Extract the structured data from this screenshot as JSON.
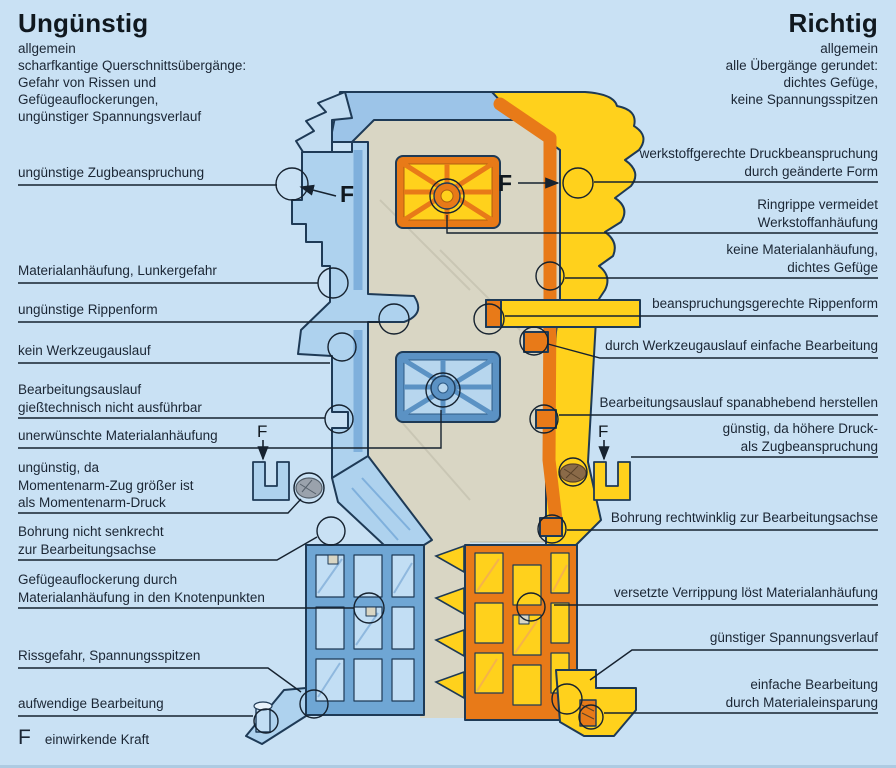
{
  "page": {
    "title_left": "Ungünstig",
    "title_right": "Richtig"
  },
  "left": {
    "heading": "Ungünstig",
    "intro": "allgemein\nscharfkantige Querschnittsübergänge:\nGefahr von Rissen und\nGefügeauflockerungen,\nungünstiger Spannungsverlauf",
    "labels": [
      {
        "text": "ungünstige Zugbeanspruchung"
      },
      {
        "text": "Materialanhäufung, Lunkergefahr"
      },
      {
        "text": "ungünstige Rippenform"
      },
      {
        "text": "kein Werkzeugauslauf"
      },
      {
        "text": "Bearbeitungsauslauf\ngießtechnisch nicht ausführbar"
      },
      {
        "text": "unerwünschte Materialanhäufung"
      },
      {
        "text": "ungünstig, da\nMomentenarm-Zug größer ist\nals Momentenarm-Druck"
      },
      {
        "text": "Bohrung nicht senkrecht\nzur Bearbeitungsachse"
      },
      {
        "text": "Gefügeauflockerung durch\nMaterialanhäufung in den Knotenpunkten"
      },
      {
        "text": "Rissgefahr, Spannungsspitzen"
      },
      {
        "text": "aufwendige Bearbeitung"
      }
    ]
  },
  "right": {
    "heading": "Richtig",
    "intro": "allgemein\nalle Übergänge gerundet:\ndichtes Gefüge,\nkeine Spannungsspitzen",
    "labels": [
      {
        "text": "werkstoffgerechte Druckbeanspruchung\ndurch geänderte Form"
      },
      {
        "text": "Ringrippe vermeidet\nWerkstoffanhäufung"
      },
      {
        "text": "keine Materialanhäufung,\ndichtes Gefüge"
      },
      {
        "text": "beanspruchungsgerechte Rippenform"
      },
      {
        "text": "durch Werkzeugauslauf einfache Bearbeitung"
      },
      {
        "text": "Bearbeitungsauslauf spanabhebend herstellen"
      },
      {
        "text": "günstig, da höhere Druck-\nals Zugbeanspruchung"
      },
      {
        "text": "Bohrung rechtwinklig zur Bearbeitungsachse"
      },
      {
        "text": "versetzte Verrippung löst Materialanhäufung"
      },
      {
        "text": "günstiger Spannungsverlauf"
      },
      {
        "text": "einfache Bearbeitung\ndurch Materialeinsparung"
      }
    ]
  },
  "force": {
    "symbol": "F",
    "legend_text": "einwirkende Kraft"
  },
  "colors": {
    "background": "#c9e1f4",
    "blue_light": "#bcdaf0",
    "blue_mid": "#6fa6d4",
    "blue_frame": "#5b92c4",
    "yellow": "#ffd11c",
    "orange": "#e87a18",
    "beige": "#d9d6c4",
    "outline": "#1e3a56",
    "text": "#1b2634"
  }
}
